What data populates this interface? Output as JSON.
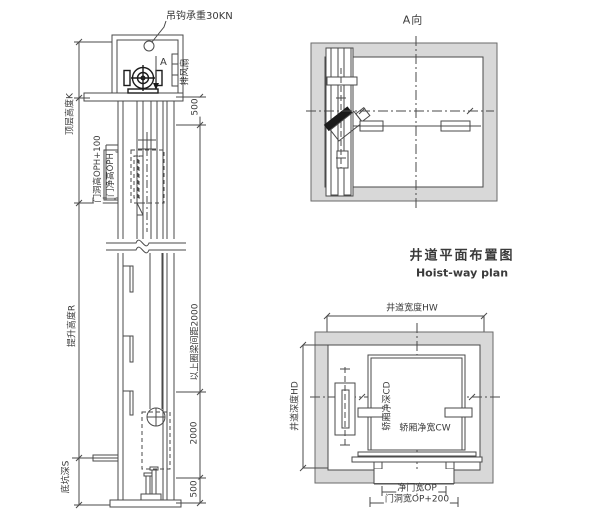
{
  "colors": {
    "line": "#4a4a4a",
    "wall_fill": "#d8d8d8",
    "machine_dark": "#1a1a1a",
    "text": "#3a3a3a"
  },
  "elevation": {
    "hook_load_label": "吊钩承重30KN",
    "section_arrow_label": "A",
    "exhaust_fan_label": "排风扇",
    "top_floor_height_label": "顶层高度K",
    "door_opening_height_label": "门洞高OPH+100",
    "door_clear_height_label": "门净高OPH",
    "travel_height_label": "提升高度R",
    "pit_depth_label": "底坑深S",
    "dims": {
      "top_500": "500",
      "ring_beam_spacing": "以上圈梁间距2000",
      "lower_2000": "2000",
      "bottom_500": "500"
    }
  },
  "plan_a": {
    "title": "A向"
  },
  "hoistway_plan": {
    "title": "井道平面布置图",
    "subtitle": "Hoist-way plan",
    "hoistway_width_label": "井道宽度HW",
    "hoistway_depth_label": "井道深度HD",
    "car_depth_label": "轿厢净深CD",
    "car_width_label": "轿厢净宽CW",
    "door_clear_width_label": "净门宽OP",
    "door_opening_width_label": "门洞宽OP+200"
  }
}
